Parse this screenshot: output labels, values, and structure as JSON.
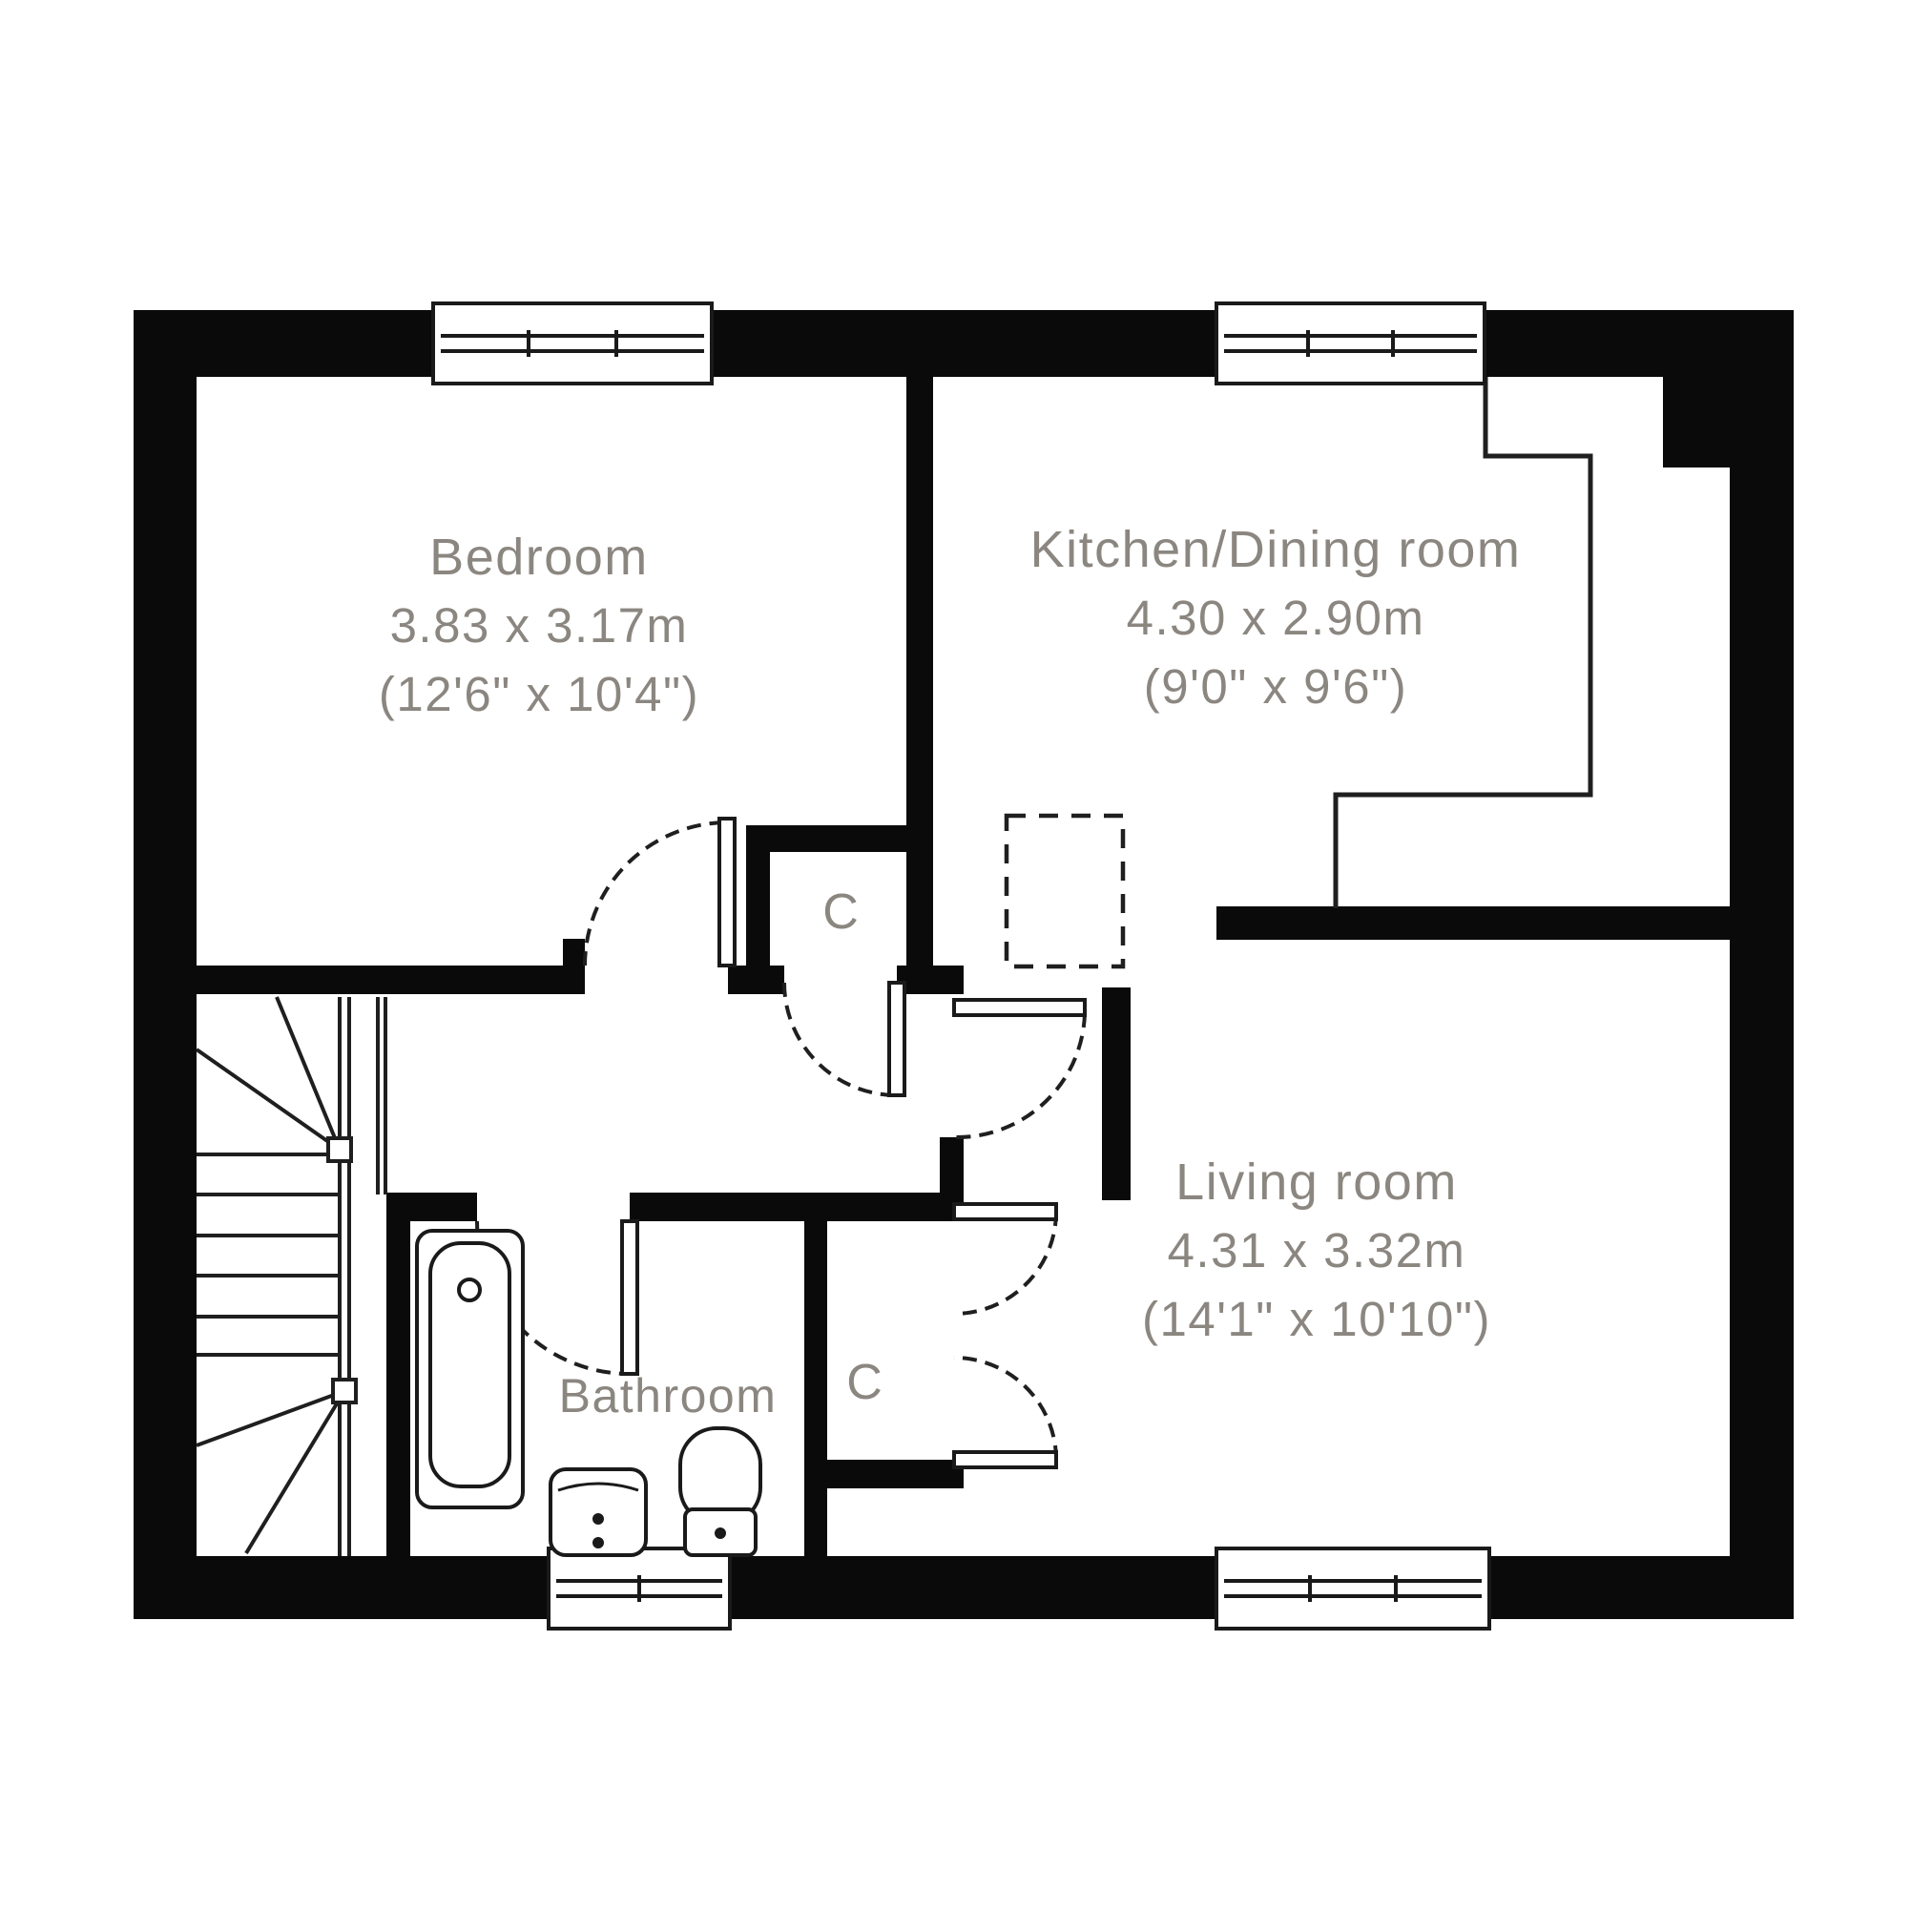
{
  "plan_title": "Floor plan",
  "rooms": {
    "bedroom": {
      "name": "Bedroom",
      "size_metric": "3.83 x 3.17m",
      "size_imperial": "(12'6\" x 10'4\")"
    },
    "kitchen": {
      "name": "Kitchen/Dining room",
      "size_metric": "4.30 x 2.90m",
      "size_imperial": "(9'0\" x 9'6\")"
    },
    "living": {
      "name": "Living room",
      "size_metric": "4.31 x 3.32m",
      "size_imperial": "(14'1\" x 10'10\")"
    },
    "bathroom": {
      "name": "Bathroom"
    }
  },
  "closets": {
    "closet1": "C",
    "closet2": "C"
  },
  "colors": {
    "wall": "#0a0a0a",
    "line": "#1f1f1f",
    "label_text": "#8b8680",
    "background": "#ffffff"
  }
}
